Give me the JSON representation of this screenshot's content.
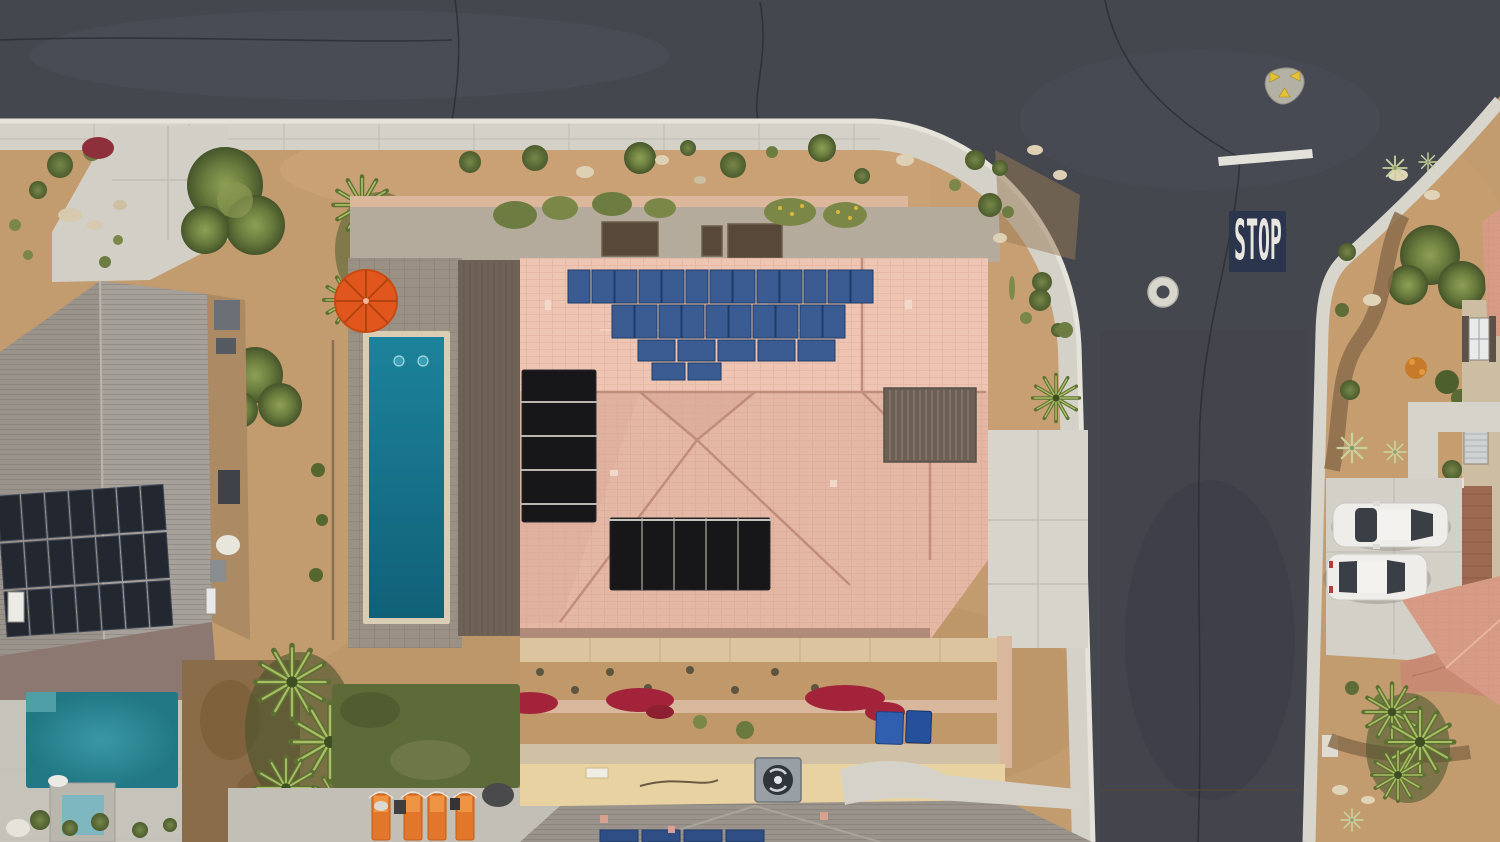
{
  "scene": {
    "title": "Aerial drone view of a desert residential neighborhood street corner",
    "road": {
      "stop_text": "STOP",
      "has_stop_line": true,
      "manhole_count": 1,
      "survey_marker_triangles": 3
    },
    "main_house": {
      "roof_style": "pink tile hip roof",
      "pv_panel_rows": [
        13,
        10,
        5,
        2
      ],
      "black_pool_heater_mats": 2,
      "lap_pool_jets": 2,
      "has_pergola": true,
      "umbrella_count": 1
    },
    "left_house": {
      "roof_style": "gray shingle",
      "pv_grid_cols": 7,
      "pv_grid_rows": 3,
      "has_pool": true,
      "has_spa": true
    },
    "bottom_house": {
      "pv_panels": 4,
      "ac_units": 1
    },
    "right_house": {
      "cars": [
        "white sedan",
        "white suv"
      ],
      "car_count": 2
    },
    "backyard": {
      "sun_loungers": 4,
      "garden_beds": 3,
      "recycle_bins": 2
    },
    "palette": {
      "asphalt": "#45474f",
      "asphalt_light": "#54565f",
      "curb": "#e6e3db",
      "sidewalk": "#d4d1c9",
      "concrete": "#d6d3cb",
      "paver_gray": "#9a9083",
      "sand": "#c29b6e",
      "sand_light": "#cfa87a",
      "gravel_dark": "#8a6c4b",
      "pink_roof": "#e4b7a4",
      "pink_roof_light": "#eec5b2",
      "roof_line": "#c08d7a",
      "patio_roof": "#6e6257",
      "pergola": "#6b6053",
      "shingle_gray": "#99938b",
      "solar_blue": "#3a5c92",
      "solar_black": "#17171a",
      "solar_dark_panel": "#232830",
      "pool_teal": "#15758d",
      "pool_left": "#2b8b98",
      "spa": "#7fb7c1",
      "umbrella": "#e0561c",
      "lounger": "#e2762a",
      "lawn": "#5d6b39",
      "dead_lawn": "#8a6c49",
      "tree": "#6b7d3e",
      "shrub": "#5e6d38",
      "palm": "#7f9246",
      "red_flowers": "#a3243a",
      "yellow_flowers": "#d9b93a",
      "wall_pink": "#dcb79c",
      "wall_beige": "#cdbda2",
      "wall_tan": "#ab8a64",
      "tan_roof": "#e9d2a2",
      "ac_gray": "#98a0a6",
      "bin_blue": "#2f5fae",
      "car_body": "#efede9",
      "car_glass": "#3a3f46",
      "stop_patch": "#2b364e",
      "stop_text_color": "#e8e6df",
      "marker_body": "#b3b0a4",
      "marker_yellow": "#e5c235"
    }
  }
}
